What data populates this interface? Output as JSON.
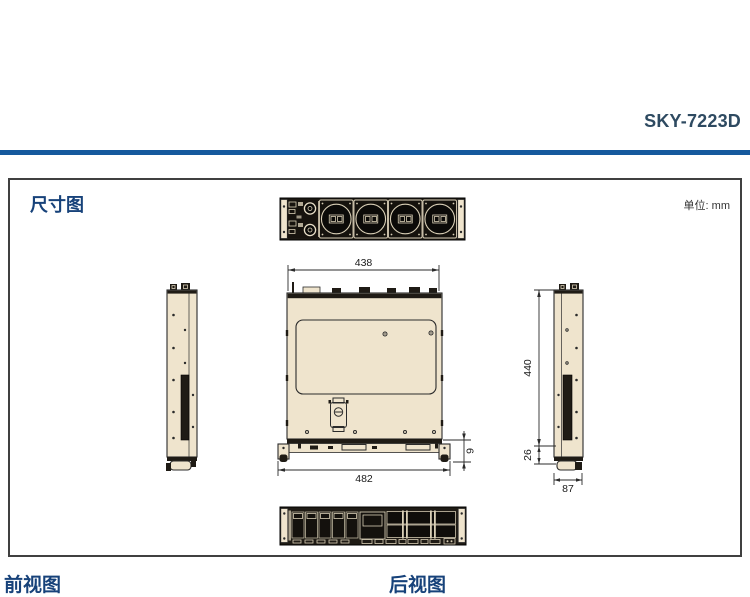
{
  "page": {
    "product_model": "SKY-7223D",
    "section_title": "尺寸图",
    "unit_label": "单位: mm",
    "front_view_label": "前视图",
    "rear_view_label": "后视图"
  },
  "dimensions": {
    "top_width_mm": "438",
    "overall_width_mm": "482",
    "chassis_depth_mm": "440",
    "front_section_mm": "26",
    "chassis_height_mm": "87",
    "ear_offset_mm": "9"
  },
  "colors": {
    "accent_rule": "#15599d",
    "heading_navy": "#17427a",
    "model_title_color": "#2e4a61",
    "chassis_beige": "#efe4cd",
    "drawing_line": "#2b2b2b"
  }
}
